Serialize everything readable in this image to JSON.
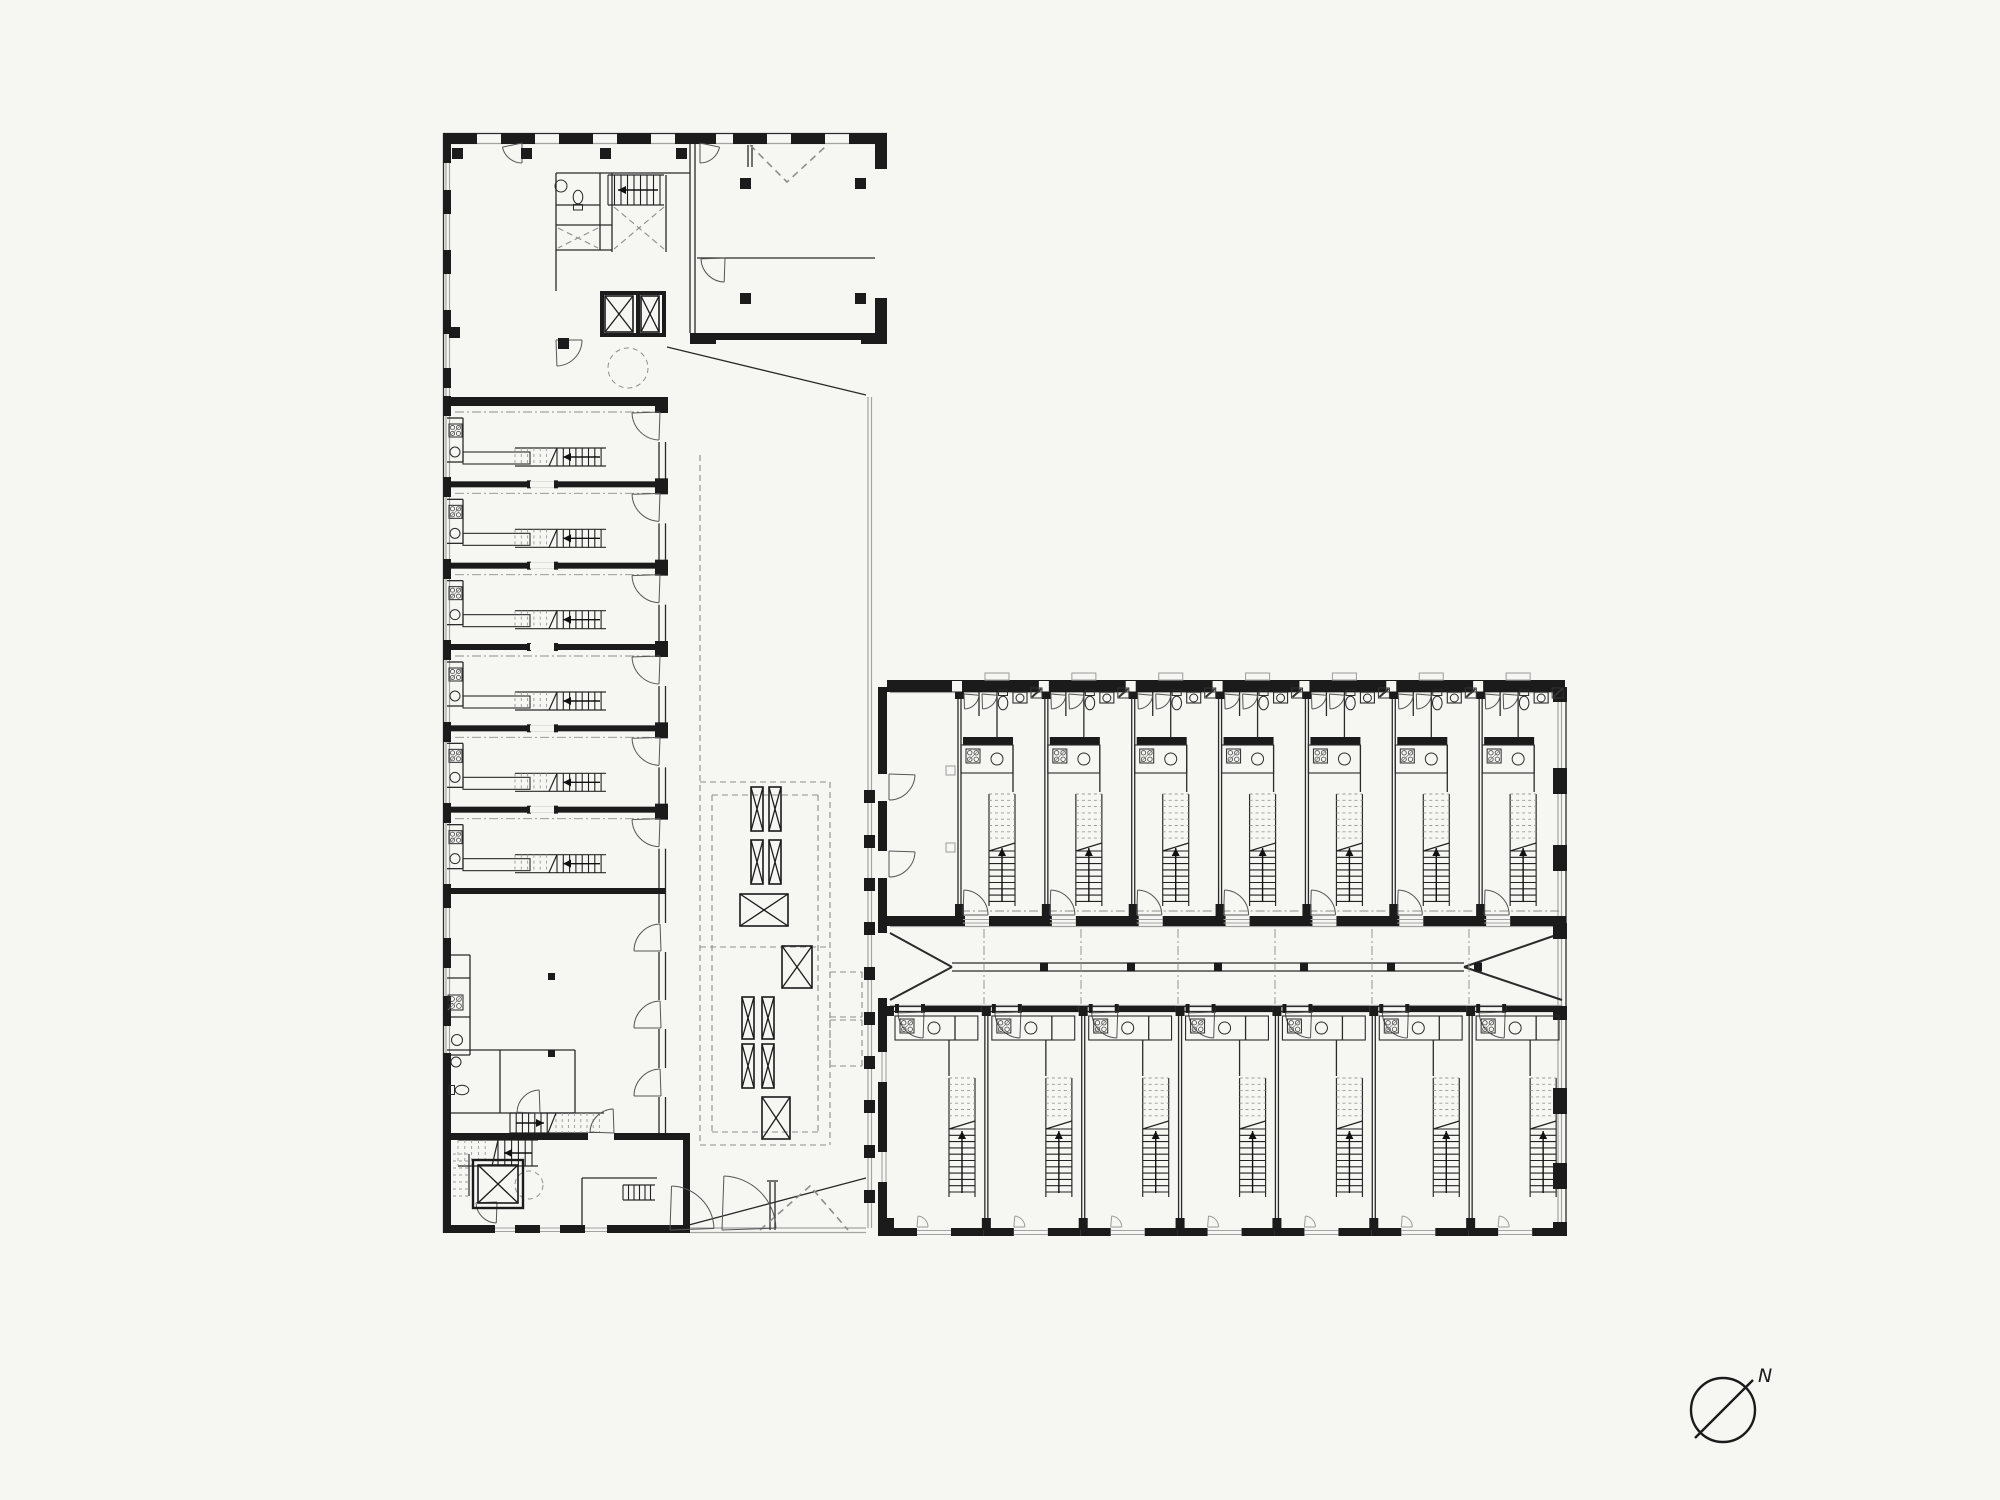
{
  "canvas": {
    "w": 2000,
    "h": 1500,
    "bg": "#f6f6f3",
    "ink": "#1b1b1b",
    "line": "#2a2a2a",
    "gray": "#a3a3a3",
    "dash": "#8d8d8d"
  },
  "north_arrow": {
    "label": "N",
    "cx": 1723,
    "cy": 1410,
    "r": 32,
    "line": [
      1695,
      1438,
      1753,
      1380
    ],
    "label_x": 1758,
    "label_y": 1382
  },
  "rows": {
    "left": {
      "x": 443,
      "w": 222,
      "top": 400,
      "bottom": 888,
      "count": 6
    },
    "top": {
      "x0": 957,
      "x1": 1565,
      "top": 687,
      "bottom": 926,
      "count": 7
    },
    "bottom": {
      "x0": 887,
      "x1": 1565,
      "top": 1006,
      "bottom": 1236,
      "count": 7
    },
    "corridor": {
      "x0": 890,
      "x1": 1562,
      "y0": 926,
      "y1": 1006,
      "band": [
        952,
        1464,
        963,
        971
      ],
      "ticks": [
        1044,
        1131,
        1218,
        1304,
        1391,
        1478
      ],
      "grid": [
        984,
        1081,
        1178,
        1275,
        1372,
        1469
      ]
    }
  },
  "envelope": {
    "north": {
      "x0": 443,
      "x1": 887,
      "y": 133,
      "h": 11,
      "pier": 34,
      "gap": 24
    },
    "west": {
      "x": 443,
      "w": 8,
      "piers": [
        [
          133,
          30
        ],
        [
          190,
          24
        ],
        [
          250,
          24
        ],
        [
          310,
          24
        ],
        [
          368,
          20
        ],
        [
          396,
          20
        ],
        [
          477,
          20
        ],
        [
          559,
          20
        ],
        [
          640,
          20
        ],
        [
          722,
          20
        ],
        [
          803,
          20
        ],
        [
          884,
          24
        ],
        [
          938,
          30
        ],
        [
          996,
          30
        ],
        [
          1053,
          80
        ],
        [
          1133,
          99
        ],
        [
          1218,
          15
        ]
      ]
    },
    "atrium_piers": {
      "x": 864,
      "w": 11,
      "h": 13,
      "ys": [
        790,
        835,
        878,
        922,
        967,
        1012,
        1056,
        1100,
        1145,
        1190
      ]
    },
    "east": {
      "x": 1553,
      "w": 14,
      "piers": [
        [
          687,
          15
        ],
        [
          768,
          26
        ],
        [
          845,
          26
        ],
        [
          923,
          16
        ],
        [
          1006,
          14
        ],
        [
          1088,
          26
        ],
        [
          1163,
          26
        ],
        [
          1222,
          14
        ]
      ]
    },
    "right_north": {
      "x": 887,
      "y": 680,
      "w": 678,
      "h": 12
    }
  },
  "primitives": {
    "walls": [
      [
        443,
        133,
        8,
        30
      ],
      [
        443,
        1218,
        8,
        15
      ],
      [
        690,
        133,
        26,
        11
      ],
      [
        849,
        133,
        38,
        11
      ],
      [
        875,
        133,
        12,
        36
      ],
      [
        875,
        298,
        12,
        42
      ],
      [
        861,
        333,
        26,
        11
      ],
      [
        690,
        333,
        26,
        11
      ],
      [
        690,
        333,
        197,
        7
      ],
      [
        443,
        397,
        223,
        7
      ],
      [
        887,
        916,
        70,
        10
      ],
      [
        443,
        1133,
        222,
        7
      ],
      [
        595,
        1133,
        95,
        7
      ],
      [
        683,
        1133,
        7,
        99
      ],
      [
        443,
        1225,
        247,
        8
      ],
      [
        1555,
        687,
        12,
        14
      ],
      [
        1555,
        1222,
        12,
        14
      ],
      [
        878,
        687,
        9,
        87
      ],
      [
        878,
        801,
        9,
        50
      ],
      [
        878,
        878,
        9,
        38
      ],
      [
        878,
        916,
        9,
        17
      ],
      [
        878,
        998,
        9,
        8
      ],
      [
        878,
        1006,
        9,
        46
      ],
      [
        878,
        1082,
        9,
        70
      ],
      [
        878,
        1182,
        9,
        54
      ],
      [
        600,
        291,
        4,
        46
      ],
      [
        636,
        291,
        4,
        46
      ],
      [
        662,
        291,
        4,
        46
      ],
      [
        600,
        291,
        66,
        4
      ],
      [
        600,
        333,
        66,
        4
      ]
    ],
    "thin": [
      [
        443,
        133.5,
        887,
        133.5
      ],
      [
        443.5,
        133,
        443.5,
        1233
      ],
      [
        1566,
        687,
        1566,
        1236
      ],
      [
        556,
        173,
        690,
        173
      ],
      [
        556,
        173,
        556,
        291
      ],
      [
        600,
        173,
        600,
        250
      ],
      [
        556,
        205,
        600,
        205
      ],
      [
        556,
        225,
        612,
        225
      ],
      [
        556,
        250,
        612,
        250
      ],
      [
        612,
        173,
        612,
        252
      ],
      [
        666,
        175,
        666,
        252
      ],
      [
        690,
        143,
        690,
        333
      ],
      [
        695,
        143,
        695,
        333
      ],
      [
        697,
        258,
        875,
        258
      ],
      [
        748,
        145,
        748,
        167
      ],
      [
        752,
        145,
        752,
        167
      ],
      [
        738,
        143,
        748,
        143
      ],
      [
        667,
        347,
        866,
        395
      ],
      [
        670,
        1230,
        866,
        1178
      ],
      [
        770,
        1182,
        770,
        1230
      ],
      [
        775,
        1182,
        775,
        1230
      ],
      [
        767,
        1181,
        778,
        1181
      ],
      [
        447,
        955,
        470,
        955
      ],
      [
        470,
        955,
        470,
        1055
      ],
      [
        447,
        1055,
        470,
        1055
      ],
      [
        447,
        978,
        470,
        978
      ],
      [
        447,
        1017,
        470,
        1017
      ],
      [
        447,
        1050,
        575,
        1050
      ],
      [
        575,
        1050,
        575,
        1113
      ],
      [
        447,
        1113,
        575,
        1113
      ],
      [
        500,
        1050,
        500,
        1113
      ],
      [
        582,
        1178,
        582,
        1225
      ],
      [
        582,
        1178,
        657,
        1178
      ],
      [
        952,
        963,
        1464,
        963
      ],
      [
        952,
        971,
        1464,
        971
      ],
      [
        890,
        933,
        952,
        967,
        2
      ],
      [
        890,
        1000,
        952,
        967,
        2
      ],
      [
        1562,
        933,
        1464,
        967,
        2
      ],
      [
        1562,
        1000,
        1464,
        967,
        2
      ],
      [
        659,
        400,
        659,
        888
      ],
      [
        665.5,
        400,
        665.5,
        888
      ],
      [
        659,
        888,
        659,
        1133
      ],
      [
        665.5,
        888,
        665.5,
        1133
      ]
    ],
    "gray": [
      [
        446,
        147,
        446,
        1225
      ],
      [
        449.5,
        147,
        449.5,
        1225
      ],
      [
        868,
        397,
        868,
        1228
      ],
      [
        871.5,
        397,
        871.5,
        1228
      ],
      [
        1558,
        701,
        1558,
        1222
      ],
      [
        1561.5,
        701,
        1561.5,
        1222
      ],
      [
        450,
        143.5,
        884,
        143.5
      ],
      [
        890,
        692.5,
        1562,
        692.5
      ],
      [
        890,
        926.5,
        1562,
        926.5
      ],
      [
        890,
        1005.5,
        1562,
        1005.5
      ],
      [
        690,
        1228,
        866,
        1228
      ],
      [
        690,
        1232.5,
        866,
        1232.5
      ]
    ],
    "sills": [
      [
        495,
        1228,
        515,
        1228
      ],
      [
        540,
        1228,
        560,
        1228
      ],
      [
        585,
        1228,
        607,
        1228
      ],
      [
        495,
        1231.5,
        515,
        1231.5
      ],
      [
        540,
        1231.5,
        560,
        1231.5
      ],
      [
        585,
        1231.5,
        607,
        1231.5
      ],
      [
        882,
        1052,
        882,
        1082
      ],
      [
        886,
        1052,
        886,
        1082
      ],
      [
        882,
        1152,
        882,
        1182
      ],
      [
        886,
        1152,
        886,
        1182
      ]
    ],
    "dashed": [
      [
        558,
        228,
        598,
        248
      ],
      [
        598,
        228,
        558,
        248
      ],
      [
        614,
        207,
        664,
        249
      ],
      [
        664,
        207,
        614,
        249
      ],
      [
        700,
        455,
        700,
        1145
      ],
      [
        700,
        782,
        830,
        782
      ],
      [
        830,
        782,
        830,
        1145
      ],
      [
        700,
        1145,
        830,
        1145
      ],
      [
        712,
        795,
        818,
        795
      ],
      [
        818,
        795,
        818,
        1132
      ],
      [
        712,
        795,
        712,
        1132
      ],
      [
        712,
        1132,
        818,
        1132
      ],
      [
        700,
        947,
        830,
        947
      ],
      [
        830,
        972,
        862,
        972
      ],
      [
        862,
        972,
        862,
        1017
      ],
      [
        830,
        1017,
        862,
        1017
      ],
      [
        830,
        972,
        830,
        1017
      ],
      [
        830,
        1020,
        862,
        1020
      ],
      [
        862,
        1020,
        862,
        1066
      ],
      [
        830,
        1066,
        862,
        1066
      ],
      [
        830,
        1020,
        830,
        1066
      ]
    ],
    "dashdot": [],
    "poly": [
      {
        "pts": [
          750,
          145,
          787,
          182,
          825,
          147
        ]
      },
      {
        "pts": [
          760,
          1230,
          810,
          1186,
          848,
          1230
        ]
      }
    ],
    "white": [
      [
        658,
        923,
        9,
        29
      ],
      [
        658,
        1000,
        9,
        29
      ],
      [
        658,
        1068,
        9,
        29
      ]
    ],
    "punch": [
      [
        495,
        1225,
        20,
        8
      ],
      [
        540,
        1225,
        20,
        8
      ],
      [
        585,
        1225,
        22,
        8
      ],
      [
        588,
        1133,
        26,
        7
      ],
      [
        880,
        774,
        8,
        27
      ],
      [
        880,
        851,
        8,
        27
      ],
      [
        880,
        1052,
        8,
        30
      ],
      [
        880,
        1152,
        8,
        30
      ]
    ],
    "arcs": [
      {
        "c": [
          522,
          143
        ],
        "r": 20,
        "a0": 90,
        "a1": 168
      },
      {
        "c": [
          700,
          143
        ],
        "r": 20,
        "a0": 12,
        "a1": 90
      },
      {
        "c": [
          556,
          340
        ],
        "r": 26,
        "a0": 0,
        "a1": 88
      },
      {
        "c": [
          725,
          258
        ],
        "r": 24,
        "a0": 92,
        "a1": 178
      },
      {
        "c": [
          889,
          774
        ],
        "r": 26,
        "a0": 2,
        "a1": 90
      },
      {
        "c": [
          889,
          851
        ],
        "r": 26,
        "a0": 2,
        "a1": 90
      },
      {
        "c": [
          661,
          951
        ],
        "r": 27,
        "a0": 180,
        "a1": 268
      },
      {
        "c": [
          661,
          1028
        ],
        "r": 27,
        "a0": 180,
        "a1": 268
      },
      {
        "c": [
          661,
          1096
        ],
        "r": 27,
        "a0": 180,
        "a1": 268
      },
      {
        "c": [
          540,
          1113
        ],
        "r": 23,
        "a0": 182,
        "a1": 268
      },
      {
        "c": [
          497,
          1202
        ],
        "r": 21,
        "a0": 92,
        "a1": 178
      },
      {
        "c": [
          670,
          1230
        ],
        "r": 44,
        "a0": 272,
        "a1": 358
      },
      {
        "c": [
          722,
          1230
        ],
        "r": 54,
        "a0": 272,
        "a1": 358
      },
      {
        "c": [
          614,
          1133
        ],
        "r": 24,
        "a0": 182,
        "a1": 268
      }
    ],
    "xboxes": [
      {
        "x": 605,
        "y": 296,
        "w": 28,
        "h": 36
      },
      {
        "x": 641,
        "y": 296,
        "w": 18,
        "h": 36
      },
      {
        "x": 478,
        "y": 1165,
        "w": 40,
        "h": 38,
        "frame": true
      },
      {
        "x": 751,
        "y": 787,
        "w": 12,
        "h": 44
      },
      {
        "x": 769,
        "y": 787,
        "w": 12,
        "h": 44
      },
      {
        "x": 751,
        "y": 840,
        "w": 12,
        "h": 44
      },
      {
        "x": 769,
        "y": 840,
        "w": 12,
        "h": 44
      },
      {
        "x": 740,
        "y": 894,
        "w": 48,
        "h": 32
      },
      {
        "x": 782,
        "y": 946,
        "w": 30,
        "h": 42
      },
      {
        "x": 742,
        "y": 997,
        "w": 12,
        "h": 42
      },
      {
        "x": 762,
        "y": 997,
        "w": 12,
        "h": 42
      },
      {
        "x": 742,
        "y": 1044,
        "w": 12,
        "h": 44
      },
      {
        "x": 762,
        "y": 1044,
        "w": 12,
        "h": 44
      },
      {
        "x": 762,
        "y": 1097,
        "w": 28,
        "h": 42
      }
    ],
    "stairs": [
      {
        "x": 606,
        "y": 175,
        "w": 60,
        "h": 30,
        "dir": "h",
        "step": 6.5,
        "solid": [
          608,
          664
        ],
        "arrow": [
          658,
          618
        ]
      },
      {
        "x": 455,
        "y": 1140,
        "w": 85,
        "h": 26,
        "dir": "h",
        "step": 6.8,
        "dash": [
          458,
          492
        ],
        "solid": [
          498,
          538
        ],
        "arrow": [
          532,
          504
        ]
      },
      {
        "x": 447,
        "y": 1152,
        "w": 22,
        "h": 46,
        "dir": "v",
        "step": 7,
        "dash": [
          1154,
          1196
        ]
      },
      {
        "x": 622,
        "y": 1185,
        "w": 34,
        "h": 15,
        "dir": "h",
        "step": 5.5,
        "solid": [
          623,
          655
        ]
      },
      {
        "x": 508,
        "y": 1113,
        "w": 100,
        "h": 20,
        "dir": "h",
        "step": 6.2,
        "dash": [
          556,
          604
        ],
        "solid": [
          510,
          548
        ],
        "arrow": [
          516,
          544
        ]
      }
    ],
    "orect": [],
    "grect": [
      [
        946,
        766,
        9,
        9
      ],
      [
        946,
        843,
        9,
        9
      ]
    ],
    "stoves": [
      {
        "x": 448,
        "y": 995,
        "s": 15
      }
    ],
    "sinks": [
      {
        "x": 561,
        "y": 186,
        "r": 6
      },
      {
        "x": 457,
        "y": 1040,
        "r": 5.5
      },
      {
        "x": 456,
        "y": 1062,
        "r": 5
      }
    ],
    "toilets": [
      {
        "x": 578,
        "y": 197,
        "rot": 180
      },
      {
        "x": 462,
        "y": 1090,
        "rot": -90
      }
    ],
    "columns": [
      [
        452,
        148
      ],
      [
        521,
        148
      ],
      [
        600,
        148
      ],
      [
        676,
        148
      ],
      [
        740,
        178
      ],
      [
        855,
        178
      ],
      [
        740,
        293
      ],
      [
        855,
        293
      ],
      [
        449,
        327
      ],
      [
        558,
        338
      ],
      [
        548,
        973,
        7
      ],
      [
        548,
        1050,
        7
      ]
    ],
    "dcircles": [
      [
        628,
        368,
        20
      ],
      [
        529,
        1185,
        14
      ]
    ],
    "vents": []
  }
}
